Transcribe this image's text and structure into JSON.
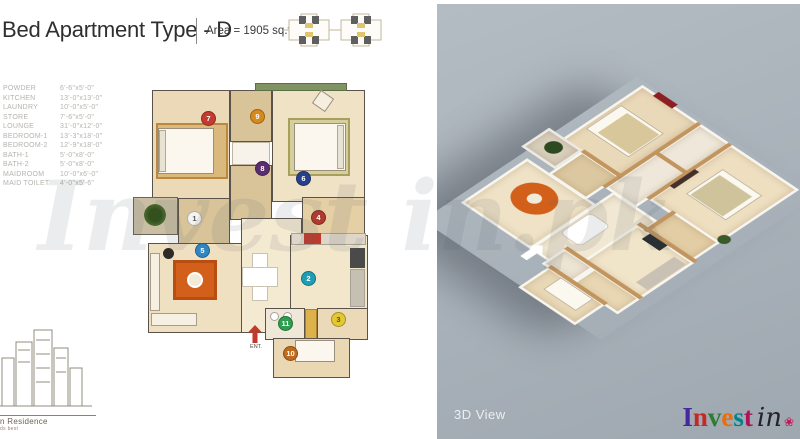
{
  "header": {
    "title": "Bed Apartment Type - D",
    "area": "Area = 1905 sq.ft."
  },
  "legend": {
    "rooms": [
      {
        "num": "1",
        "name": "POWDER",
        "size": "6'-6\"x5'-0\"",
        "color": "#f4f3ef",
        "text": "#555555"
      },
      {
        "num": "2",
        "name": "KITCHEN",
        "size": "13'-0\"x13'-0\"",
        "color": "#1e9eb4",
        "text": "#ffffff"
      },
      {
        "num": "3",
        "name": "LAUNDRY",
        "size": "10'-0\"x5'-0\"",
        "color": "#e3c832",
        "text": "#5e5200"
      },
      {
        "num": "4",
        "name": "STORE",
        "size": "7'-6\"x5'-0\"",
        "color": "#b03a2e",
        "text": "#ffffff"
      },
      {
        "num": "5",
        "name": "LOUNGE",
        "size": "31'-0\"x12'-0\"",
        "color": "#2f86c2",
        "text": "#ffffff"
      },
      {
        "num": "6",
        "name": "BEDROOM-1",
        "size": "13'-3\"x18'-0\"",
        "color": "#27408b",
        "text": "#ffffff"
      },
      {
        "num": "7",
        "name": "BEDROOM-2",
        "size": "12'-9\"x18'-0\"",
        "color": "#c23b2e",
        "text": "#ffffff"
      },
      {
        "num": "8",
        "name": "BATH-1",
        "size": "5'-0\"x8'-0\"",
        "color": "#5b2d6e",
        "text": "#ffffff"
      },
      {
        "num": "9",
        "name": "BATH-2",
        "size": "5'-0\"x8'-0\"",
        "color": "#d6891c",
        "text": "#ffffff"
      },
      {
        "num": "10",
        "name": "MAIDROOM",
        "size": "10'-0\"x6'-0\"",
        "color": "#c06a1e",
        "text": "#ffffff"
      },
      {
        "num": "11",
        "name": "MAID TOILET",
        "size": "4'-0\"x5'-6\"",
        "color": "#2f9e4f",
        "text": "#ffffff"
      }
    ]
  },
  "plan": {
    "ent_label": "ENT."
  },
  "watermark": "Invest in.pk",
  "footer": {
    "view_label": "3D View",
    "brand_word": "Invest",
    "brand_suffix": "in",
    "brand_colors": [
      "#4527a0",
      "#c62828",
      "#2e7d32",
      "#ef6c00",
      "#00838f",
      "#ad1457"
    ]
  },
  "logo": {
    "name": "n Residence",
    "tagline": "ds best"
  },
  "colors": {
    "panel_bg": "#a9b2ba",
    "floor": "#ead9b8",
    "wall": "#5a534c",
    "rug": "#d2601a",
    "entry_arrow": "#c0392b"
  }
}
